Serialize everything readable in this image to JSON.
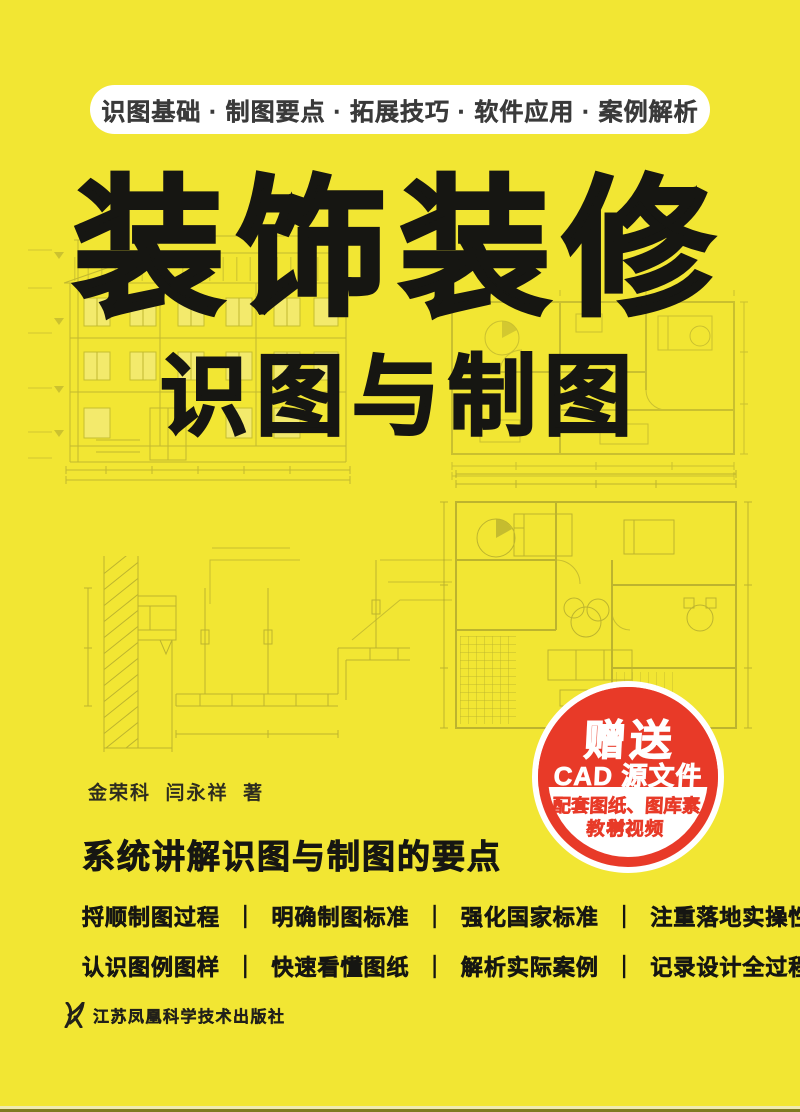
{
  "cover": {
    "banner": {
      "text": "识图基础 · 制图要点 · 拓展技巧 · 软件应用 · 案例解析"
    },
    "title": "装饰装修",
    "subtitle": "识图与制图",
    "authors": {
      "names": [
        "金荣科",
        "闫永祥"
      ],
      "suffix": "著"
    },
    "headline": "系统讲解识图与制图的要点",
    "features": {
      "separator": "｜",
      "rows": [
        [
          "捋顺制图过程",
          "明确制图标准",
          "强化国家标准",
          "注重落地实操性"
        ],
        [
          "认识图例图样",
          "快速看懂图纸",
          "解析实际案例",
          "记录设计全过程"
        ]
      ]
    },
    "badge": {
      "line1": "赠送",
      "line2": "CAD 源文件",
      "line3": "配套图纸、图库素材、",
      "line4": "教学视频"
    },
    "publisher": {
      "name": "江苏凤凰科学技术出版社",
      "logo": "phoenix-logo"
    },
    "background_art": {
      "description_items": [
        "house-elevation-drawing",
        "floor-plan-upper-right",
        "ceiling-section-detail-lower-left",
        "floor-plan-lower-right"
      ]
    },
    "colors": {
      "background": "#F2E633",
      "accent_red": "#E83A28",
      "ink": "#161612",
      "drawing_line": "#9B942C",
      "banner_bg": "#FFFFFF",
      "banner_text": "#3A3A3A"
    }
  }
}
